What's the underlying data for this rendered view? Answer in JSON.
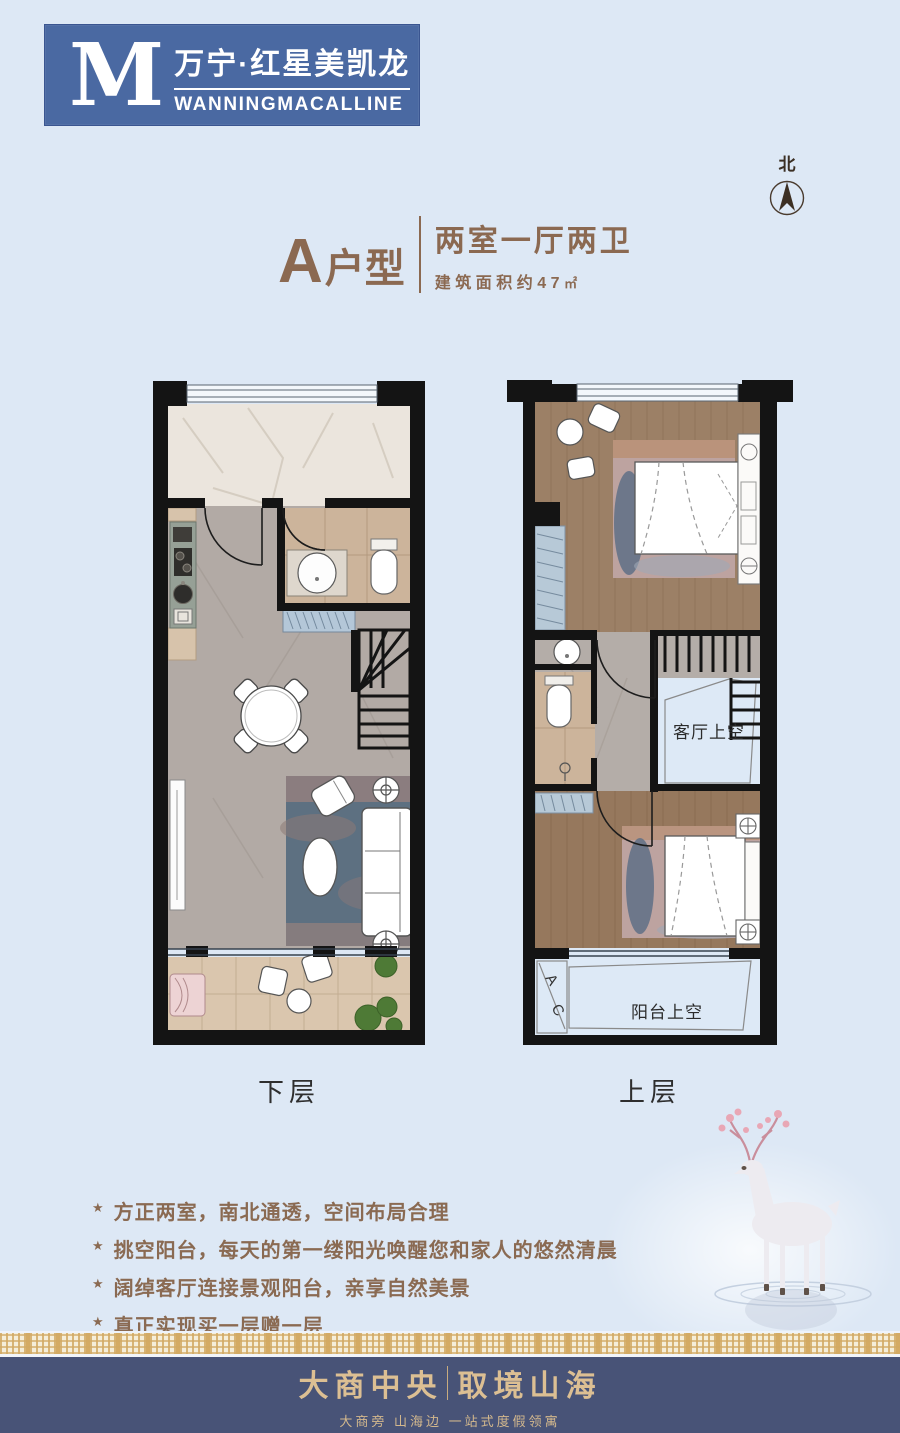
{
  "logo": {
    "monogram": "M",
    "name_cn": "万宁·红星美凯龙",
    "name_en": "WANNINGMACALLINE",
    "bg_color": "#4a69a2"
  },
  "compass": {
    "label": "北"
  },
  "title": {
    "unit_letter": "A",
    "unit_suffix": "户型",
    "layout": "两室一厅两卫",
    "area": "建筑面积约47",
    "area_unit": "㎡",
    "color": "#8b6951"
  },
  "plans": {
    "lower": {
      "label": "下层"
    },
    "upper": {
      "label": "上层",
      "void_living": "客厅上空",
      "void_balcony": "阳台上空",
      "ac_top": "A",
      "ac_bottom": "C"
    }
  },
  "features": {
    "bullet": "★",
    "items": [
      "方正两室，南北通透，空间布局合理",
      "挑空阳台，每天的第一缕阳光唤醒您和家人的悠然清晨",
      "阔绰客厅连接景观阳台，亲享自然美景",
      "真正实现买一层赠一层"
    ]
  },
  "footer": {
    "brand_left": "大商中央",
    "brand_right": "取境山海",
    "tagline": "大商旁 山海边 一站式度假领寓",
    "band_color": "#485377"
  }
}
